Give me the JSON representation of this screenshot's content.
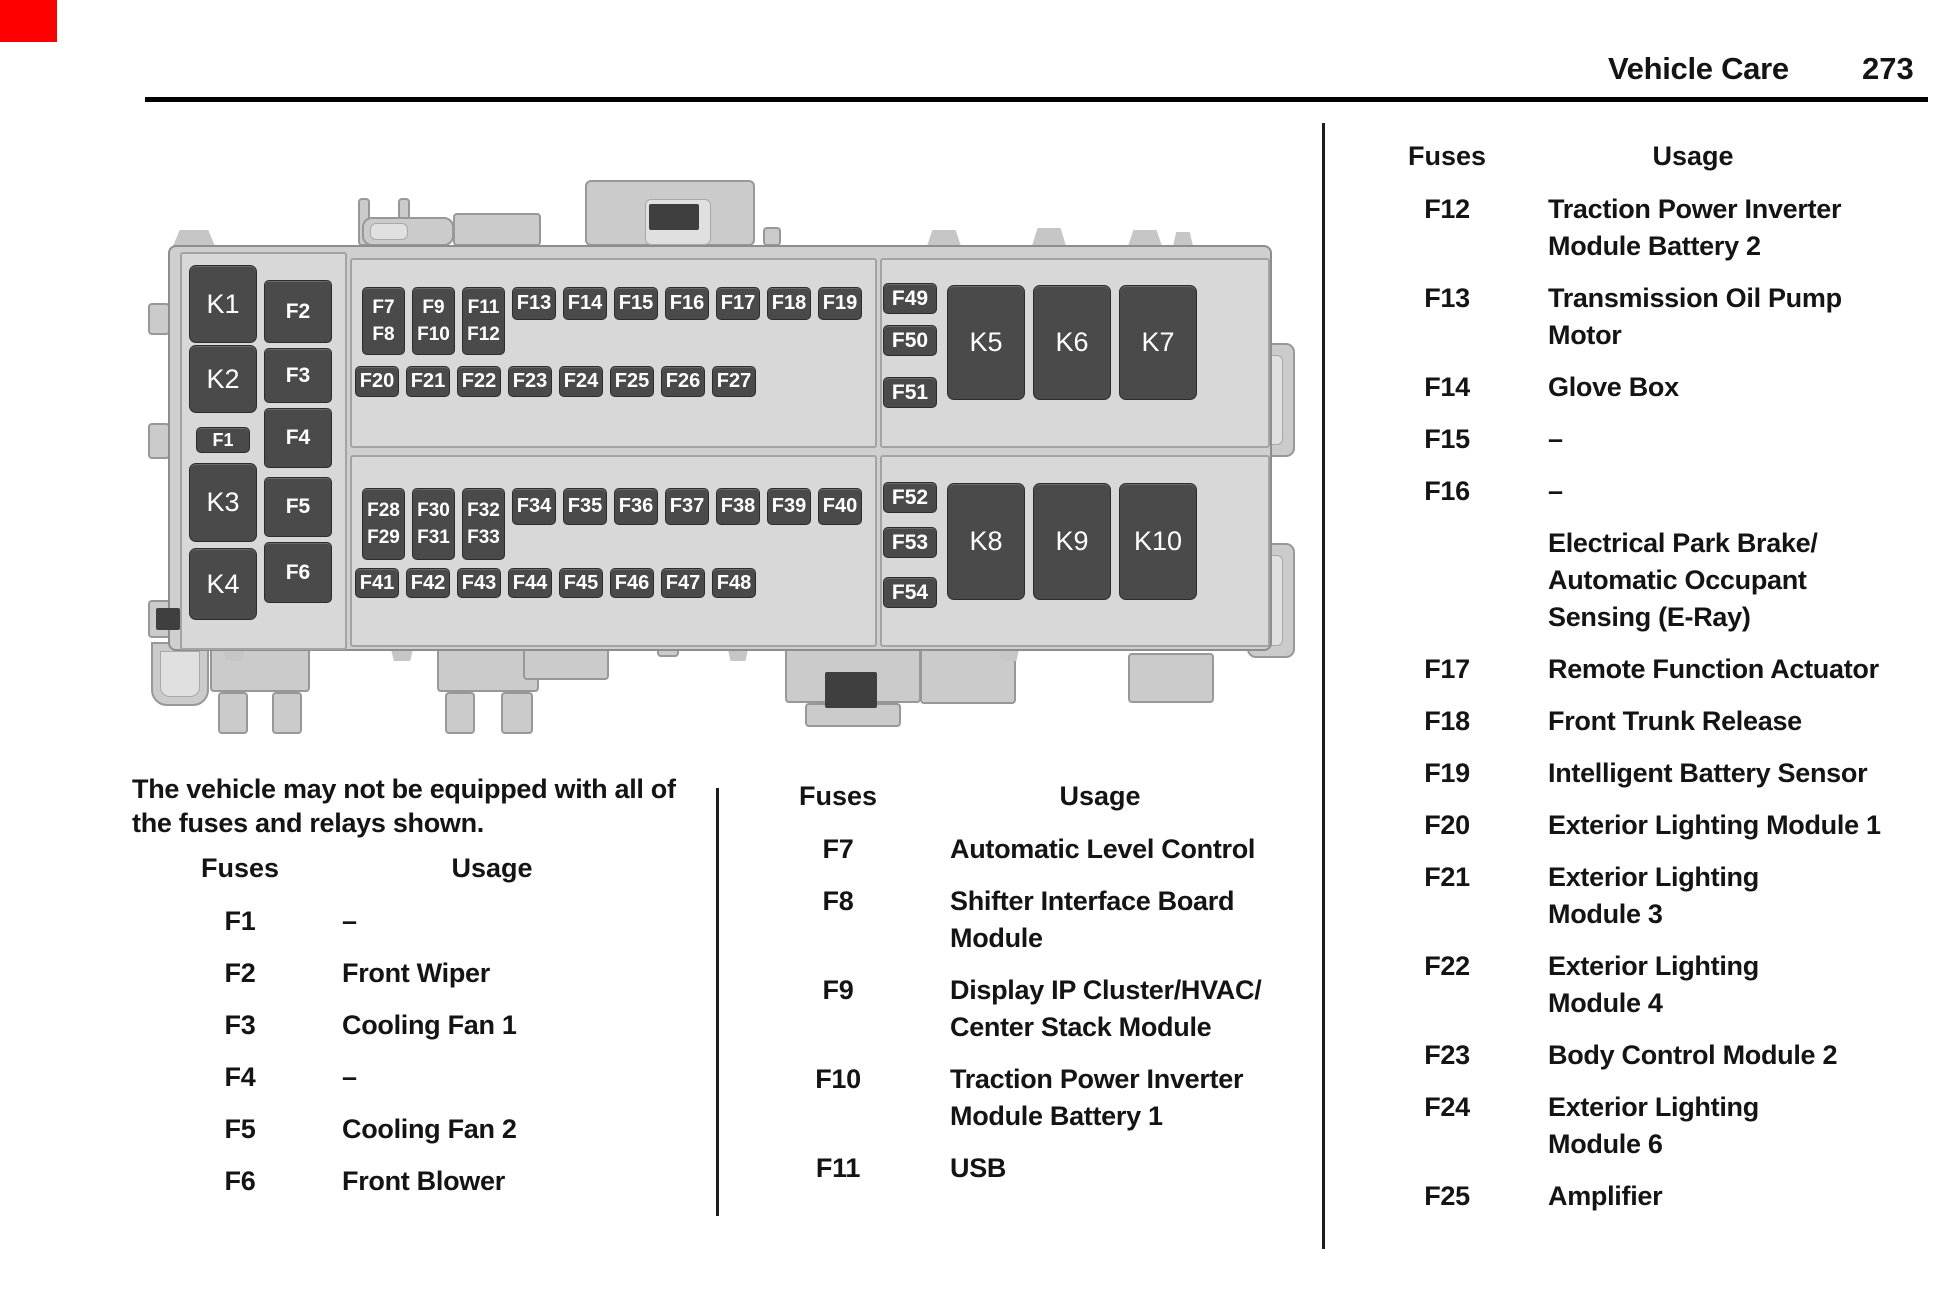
{
  "page": {
    "section_title": "Vehicle Care",
    "page_number": "273"
  },
  "corner_mark_color": "#fd0100",
  "note": "The vehicle may not be equipped with all of\nthe fuses and relays shown.",
  "diagram": {
    "left_relays": [
      "K1",
      "K2",
      "K3",
      "K4"
    ],
    "f1": "F1",
    "left_fuses": [
      "F2",
      "F3",
      "F4",
      "F5",
      "F6"
    ],
    "top_doubles": [
      [
        "F7",
        "F8"
      ],
      [
        "F9",
        "F10"
      ],
      [
        "F11",
        "F12"
      ]
    ],
    "top_singles": [
      "F13",
      "F14",
      "F15",
      "F16",
      "F17",
      "F18",
      "F19"
    ],
    "row_f20": [
      "F20",
      "F21",
      "F22",
      "F23",
      "F24",
      "F25",
      "F26",
      "F27"
    ],
    "bottom_doubles": [
      [
        "F28",
        "F29"
      ],
      [
        "F30",
        "F31"
      ],
      [
        "F32",
        "F33"
      ]
    ],
    "bottom_singles": [
      "F34",
      "F35",
      "F36",
      "F37",
      "F38",
      "F39",
      "F40"
    ],
    "row_f41": [
      "F41",
      "F42",
      "F43",
      "F44",
      "F45",
      "F46",
      "F47",
      "F48"
    ],
    "right_top_fuses": [
      "F49",
      "F50",
      "F51"
    ],
    "right_top_relays": [
      "K5",
      "K6",
      "K7"
    ],
    "right_bottom_fuses": [
      "F52",
      "F53",
      "F54"
    ],
    "right_bottom_relays": [
      "K8",
      "K9",
      "K10"
    ]
  },
  "tables": {
    "left": {
      "header_fuses": "Fuses",
      "header_usage": "Usage",
      "rows": [
        {
          "fuse": "F1",
          "usage": "–"
        },
        {
          "fuse": "F2",
          "usage": "Front Wiper"
        },
        {
          "fuse": "F3",
          "usage": "Cooling Fan 1"
        },
        {
          "fuse": "F4",
          "usage": "–"
        },
        {
          "fuse": "F5",
          "usage": "Cooling Fan 2"
        },
        {
          "fuse": "F6",
          "usage": "Front Blower"
        }
      ]
    },
    "middle": {
      "header_fuses": "Fuses",
      "header_usage": "Usage",
      "rows": [
        {
          "fuse": "F7",
          "usage": "Automatic Level Control"
        },
        {
          "fuse": "F8",
          "usage": "Shifter Interface Board\nModule"
        },
        {
          "fuse": "F9",
          "usage": "Display IP Cluster/HVAC/\nCenter Stack Module"
        },
        {
          "fuse": "F10",
          "usage": "Traction Power Inverter\nModule Battery 1"
        },
        {
          "fuse": "F11",
          "usage": "USB"
        }
      ]
    },
    "right": {
      "header_fuses": "Fuses",
      "header_usage": "Usage",
      "rows": [
        {
          "fuse": "F12",
          "usage": "Traction Power Inverter\nModule Battery 2"
        },
        {
          "fuse": "F13",
          "usage": "Transmission Oil Pump\nMotor"
        },
        {
          "fuse": "F14",
          "usage": "Glove Box"
        },
        {
          "fuse": "F15",
          "usage": "–"
        },
        {
          "fuse": "F16",
          "usage": "–"
        },
        {
          "fuse": "",
          "usage": "Electrical Park Brake/\nAutomatic Occupant\nSensing (E-Ray)"
        },
        {
          "fuse": "F17",
          "usage": "Remote Function Actuator"
        },
        {
          "fuse": "F18",
          "usage": "Front Trunk Release"
        },
        {
          "fuse": "F19",
          "usage": "Intelligent Battery Sensor"
        },
        {
          "fuse": "F20",
          "usage": "Exterior Lighting Module 1"
        },
        {
          "fuse": "F21",
          "usage": "Exterior Lighting\nModule 3"
        },
        {
          "fuse": "F22",
          "usage": "Exterior Lighting\nModule 4"
        },
        {
          "fuse": "F23",
          "usage": "Body Control Module 2"
        },
        {
          "fuse": "F24",
          "usage": "Exterior Lighting\nModule 6"
        },
        {
          "fuse": "F25",
          "usage": "Amplifier"
        }
      ]
    }
  }
}
